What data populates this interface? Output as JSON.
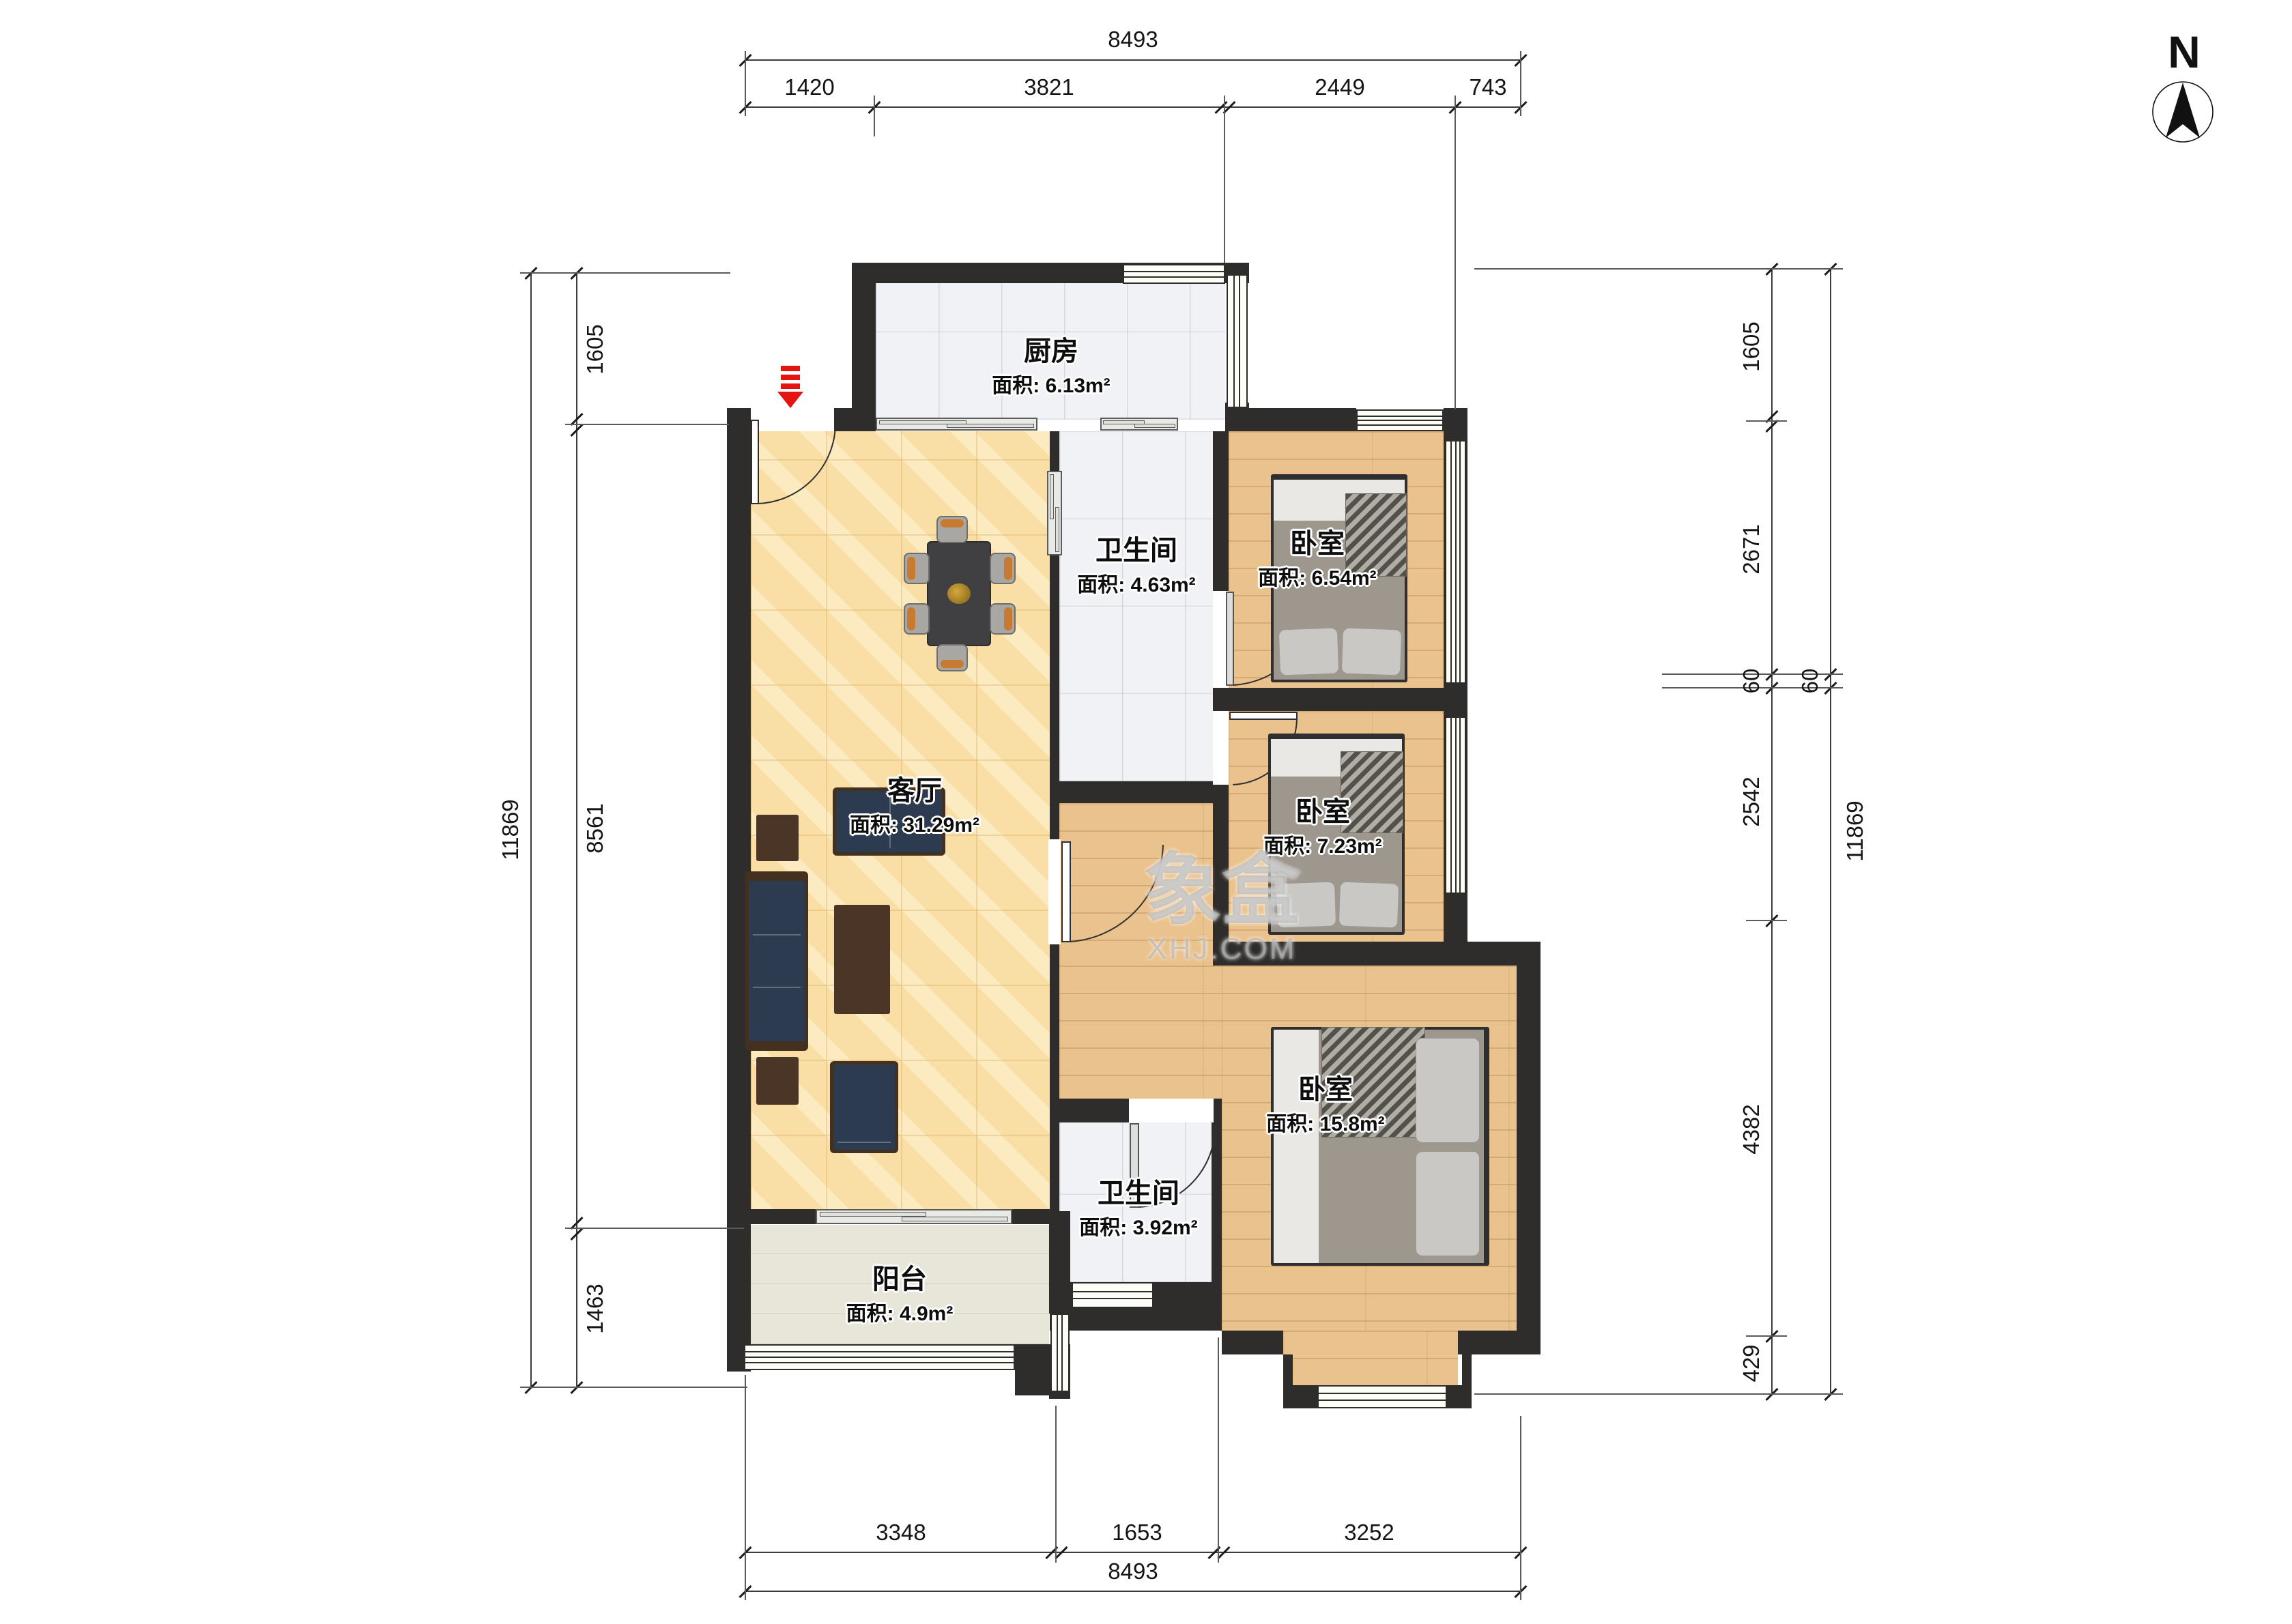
{
  "north": "N",
  "watermark": {
    "line1": "象盒",
    "line2": "XHJ.COM"
  },
  "rooms": [
    {
      "id": "kitchen",
      "name": "厨房",
      "area": "面积: 6.13m²"
    },
    {
      "id": "bath-top",
      "name": "卫生间",
      "area": "面积: 4.63m²"
    },
    {
      "id": "bedroom-1",
      "name": "卧室",
      "area": "面积: 6.54m²"
    },
    {
      "id": "bedroom-2",
      "name": "卧室",
      "area": "面积: 7.23m²"
    },
    {
      "id": "living",
      "name": "客厅",
      "area": "面积: 31.29m²"
    },
    {
      "id": "bath-low",
      "name": "卫生间",
      "area": "面积: 3.92m²"
    },
    {
      "id": "bedroom-3",
      "name": "卧室",
      "area": "面积: 15.8m²"
    },
    {
      "id": "balcony",
      "name": "阳台",
      "area": "面积: 4.9m²"
    }
  ],
  "dimensions": {
    "top": {
      "total": "8493",
      "segments": [
        "1420",
        "3821",
        "2449",
        "743"
      ]
    },
    "bottom": {
      "total": "8493",
      "segments": [
        "3348",
        "1653",
        "3252"
      ]
    },
    "left": {
      "total": "11869",
      "segments": [
        "1605",
        "8561",
        "1463"
      ]
    },
    "right": {
      "total": "11869",
      "segments": [
        "1605",
        "2671",
        "60",
        "2542",
        "4382",
        "429"
      ],
      "outer_60": "60"
    }
  },
  "colors": {
    "wall": "#2e2d2c",
    "living_floor": "#f9dfa5",
    "wood_floor": "#eac28e",
    "wet_floor": "#f1f2f5",
    "balcony_floor": "#e8e5d9",
    "entry_arrow": "#e41410",
    "sofa": "#2c3b50",
    "chair_cushion": "#c87a30"
  }
}
